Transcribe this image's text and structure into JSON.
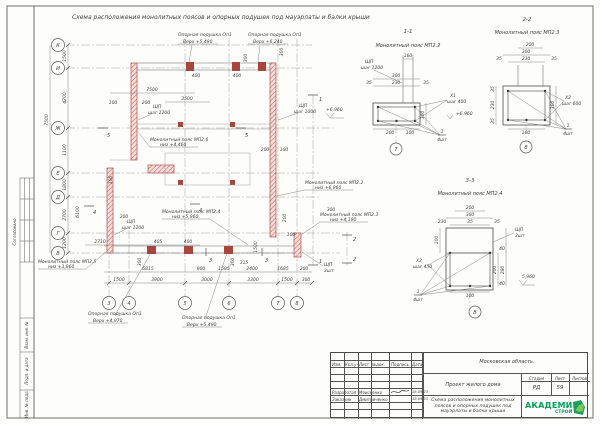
{
  "sheet": {
    "title": "Схема расположения монолитных поясов и опорных подушек под мауэрлаты и балки крыши",
    "side_labels": [
      "Согласовано",
      "Взам. инв. №",
      "Подп. и дата",
      "Инв. № подл."
    ],
    "titleblock": {
      "region": "Московская область.",
      "project": "Проект жилого дома",
      "doc_name": "Схема расположения монолитных поясов и опорных подушек под мауэрлаты и балки крыши",
      "stage_label": "Стадия",
      "sheet_label": "Лист",
      "sheets_label": "Листов",
      "stage": "РД",
      "sheet_no": "59",
      "header_cols": [
        "Изм.",
        "Кол.уч.",
        "Лист",
        "№док.",
        "Подпись",
        "Дата"
      ],
      "rows": [
        {
          "role": "Разработал",
          "name": "Моисеенко",
          "date": "18.09.23"
        },
        {
          "role": "Заказчик",
          "name": "Дмитриченко",
          "date": "18.09.23"
        }
      ],
      "logo_line1": "АКАДЕМИК",
      "logo_line2": "СТРОЙ"
    }
  },
  "plan": {
    "row_axes": [
      "К",
      "И",
      "Ж",
      "Е",
      "Д",
      "Г",
      "В"
    ],
    "col_axes": [
      "3",
      "4",
      "5",
      "6",
      "7",
      "8"
    ],
    "cuts": [
      "5",
      "5",
      "4",
      "4",
      "1",
      "1",
      "2",
      "2",
      "3",
      "3"
    ],
    "elev": "+6,960",
    "leaders": {
      "pad_t1": {
        "a": "Опорная подушка Оп1",
        "b": "Верх +5,490"
      },
      "pad_t2": {
        "a": "Опорная подушка Оп1",
        "b": "Верх +6,240"
      },
      "belt26": {
        "a": "Монолитный пояс МП2.6",
        "b": "низ +4,460"
      },
      "belt22": {
        "a": "Монолитный пояс МП2.2",
        "b": "низ +6,960"
      },
      "belt24": {
        "a": "Монолитный пояс МП2.4",
        "b": "низ +5,960"
      },
      "belt23": {
        "a": "Монолитный пояс МП2.3",
        "b": "низ +4,190"
      },
      "belt25": {
        "a": "Монолитный пояс МП2.5",
        "b": "низ +3,960"
      },
      "pad_b1": {
        "a": "Опорная подушка Оп1",
        "b": "Верх +4,970"
      },
      "pad_b2": {
        "a": "Опорная подушка Оп1",
        "b": "Верх +5,490"
      }
    },
    "shp": [
      {
        "a": "ЩП",
        "b": "шаг 1200"
      },
      {
        "a": "ЩП",
        "b": "шаг 1000"
      },
      {
        "a": "ЩП",
        "b": "шаг 1200"
      },
      {
        "a": "ЩП",
        "b": "3шт"
      }
    ],
    "dims": {
      "b3": [
        "1500",
        "3900",
        "3000",
        "3300",
        "1500",
        "300"
      ],
      "b2": [
        "6815",
        "900",
        "1685",
        "2400",
        "1685",
        "200",
        "315"
      ],
      "b1": [
        "2710",
        "405",
        "400"
      ],
      "left_in": [
        "1500",
        "4200",
        "1100",
        "1800",
        "2700",
        "1200"
      ],
      "left_out": [
        "7500",
        "6100"
      ],
      "top": [
        "7500",
        "3500",
        "400",
        "400",
        "300",
        "300"
      ],
      "inner": [
        "100",
        "200",
        "200",
        "100",
        "200",
        "100",
        "300",
        "200",
        "1500",
        "100",
        "300",
        "300"
      ]
    }
  },
  "sections": [
    {
      "id": "1-1",
      "name": "Монолитный пояс МП2.2",
      "axis": "7",
      "top": "160",
      "w": "300",
      "wi": "230",
      "c1": "35",
      "c2": "35",
      "h": "300",
      "b1": "200",
      "b2": "100",
      "note_a": "ЩП",
      "note_b": "шаг 1200",
      "xa": "Х1",
      "xb": "шаг 400",
      "elev": "+6,960",
      "pos": "1",
      "cnt": "4шт"
    },
    {
      "id": "2-2",
      "name": "Монолитный пояс МП2.3",
      "axis": "8",
      "top": "200",
      "w": "300",
      "wi": "230",
      "c1": "35",
      "c2": "35",
      "h": "300",
      "l1": "35",
      "l2": "230",
      "l3": "35",
      "b2": "100",
      "xa": "Х2",
      "xb": "шаг 600",
      "pos": "1",
      "cnt": "4шт"
    },
    {
      "id": "3-3",
      "name": "Монолитный пояс МП2.4",
      "axis": "В",
      "top": "200",
      "w": "300",
      "wi": "230",
      "c1": "35",
      "c2": "35",
      "l0": "100",
      "r1": "40",
      "r2": "200",
      "r3": "280",
      "r4": "40",
      "b2": "100",
      "note_a": "ЩП",
      "note_b": "3шт",
      "xa": "Х2",
      "xb": "шаг 450",
      "elev": "5,960",
      "pos": "1",
      "cnt": "4шт"
    }
  ]
}
